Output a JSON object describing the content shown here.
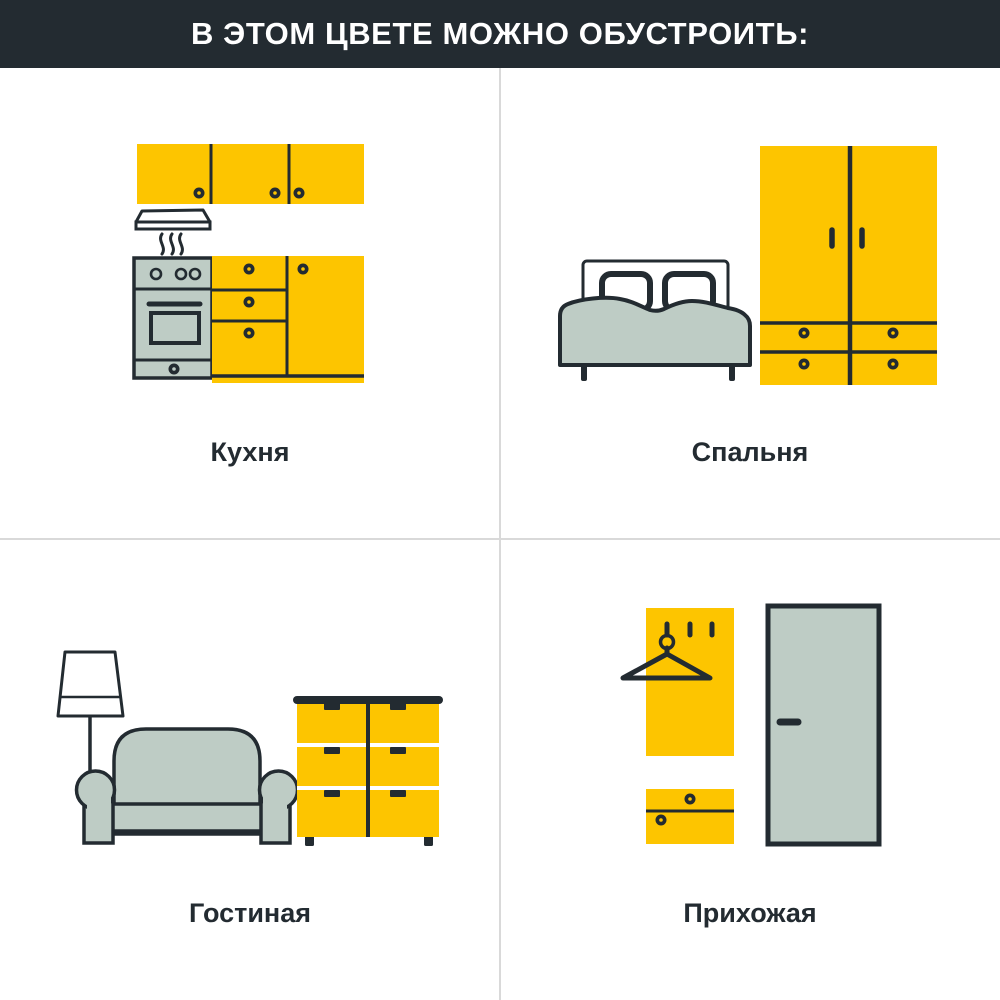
{
  "header": {
    "title": "В ЭТОМ ЦВЕТЕ МОЖНО ОБУСТРОИТЬ:"
  },
  "colors": {
    "header_bg": "#232B31",
    "header_text": "#FFFFFF",
    "accent_yellow": "#FDC500",
    "sage_green": "#BECCC5",
    "outline_dark": "#232B31",
    "divider_grey": "#D9D9D9",
    "background": "#FFFFFF"
  },
  "rooms": [
    {
      "id": "kitchen",
      "label": "Кухня",
      "icons": [
        "wall-cabinets-icon",
        "range-hood-icon",
        "steam-icon",
        "stove-oven-icon",
        "base-cabinets-icon"
      ]
    },
    {
      "id": "bedroom",
      "label": "Спальня",
      "icons": [
        "double-bed-icon",
        "wardrobe-icon"
      ]
    },
    {
      "id": "living_room",
      "label": "Гостиная",
      "icons": [
        "floor-lamp-icon",
        "sofa-icon",
        "chest-of-drawers-icon"
      ]
    },
    {
      "id": "hallway",
      "label": "Прихожая",
      "icons": [
        "coat-rack-panel-icon",
        "hanger-icon",
        "shoe-cabinet-icon",
        "door-icon"
      ]
    }
  ]
}
